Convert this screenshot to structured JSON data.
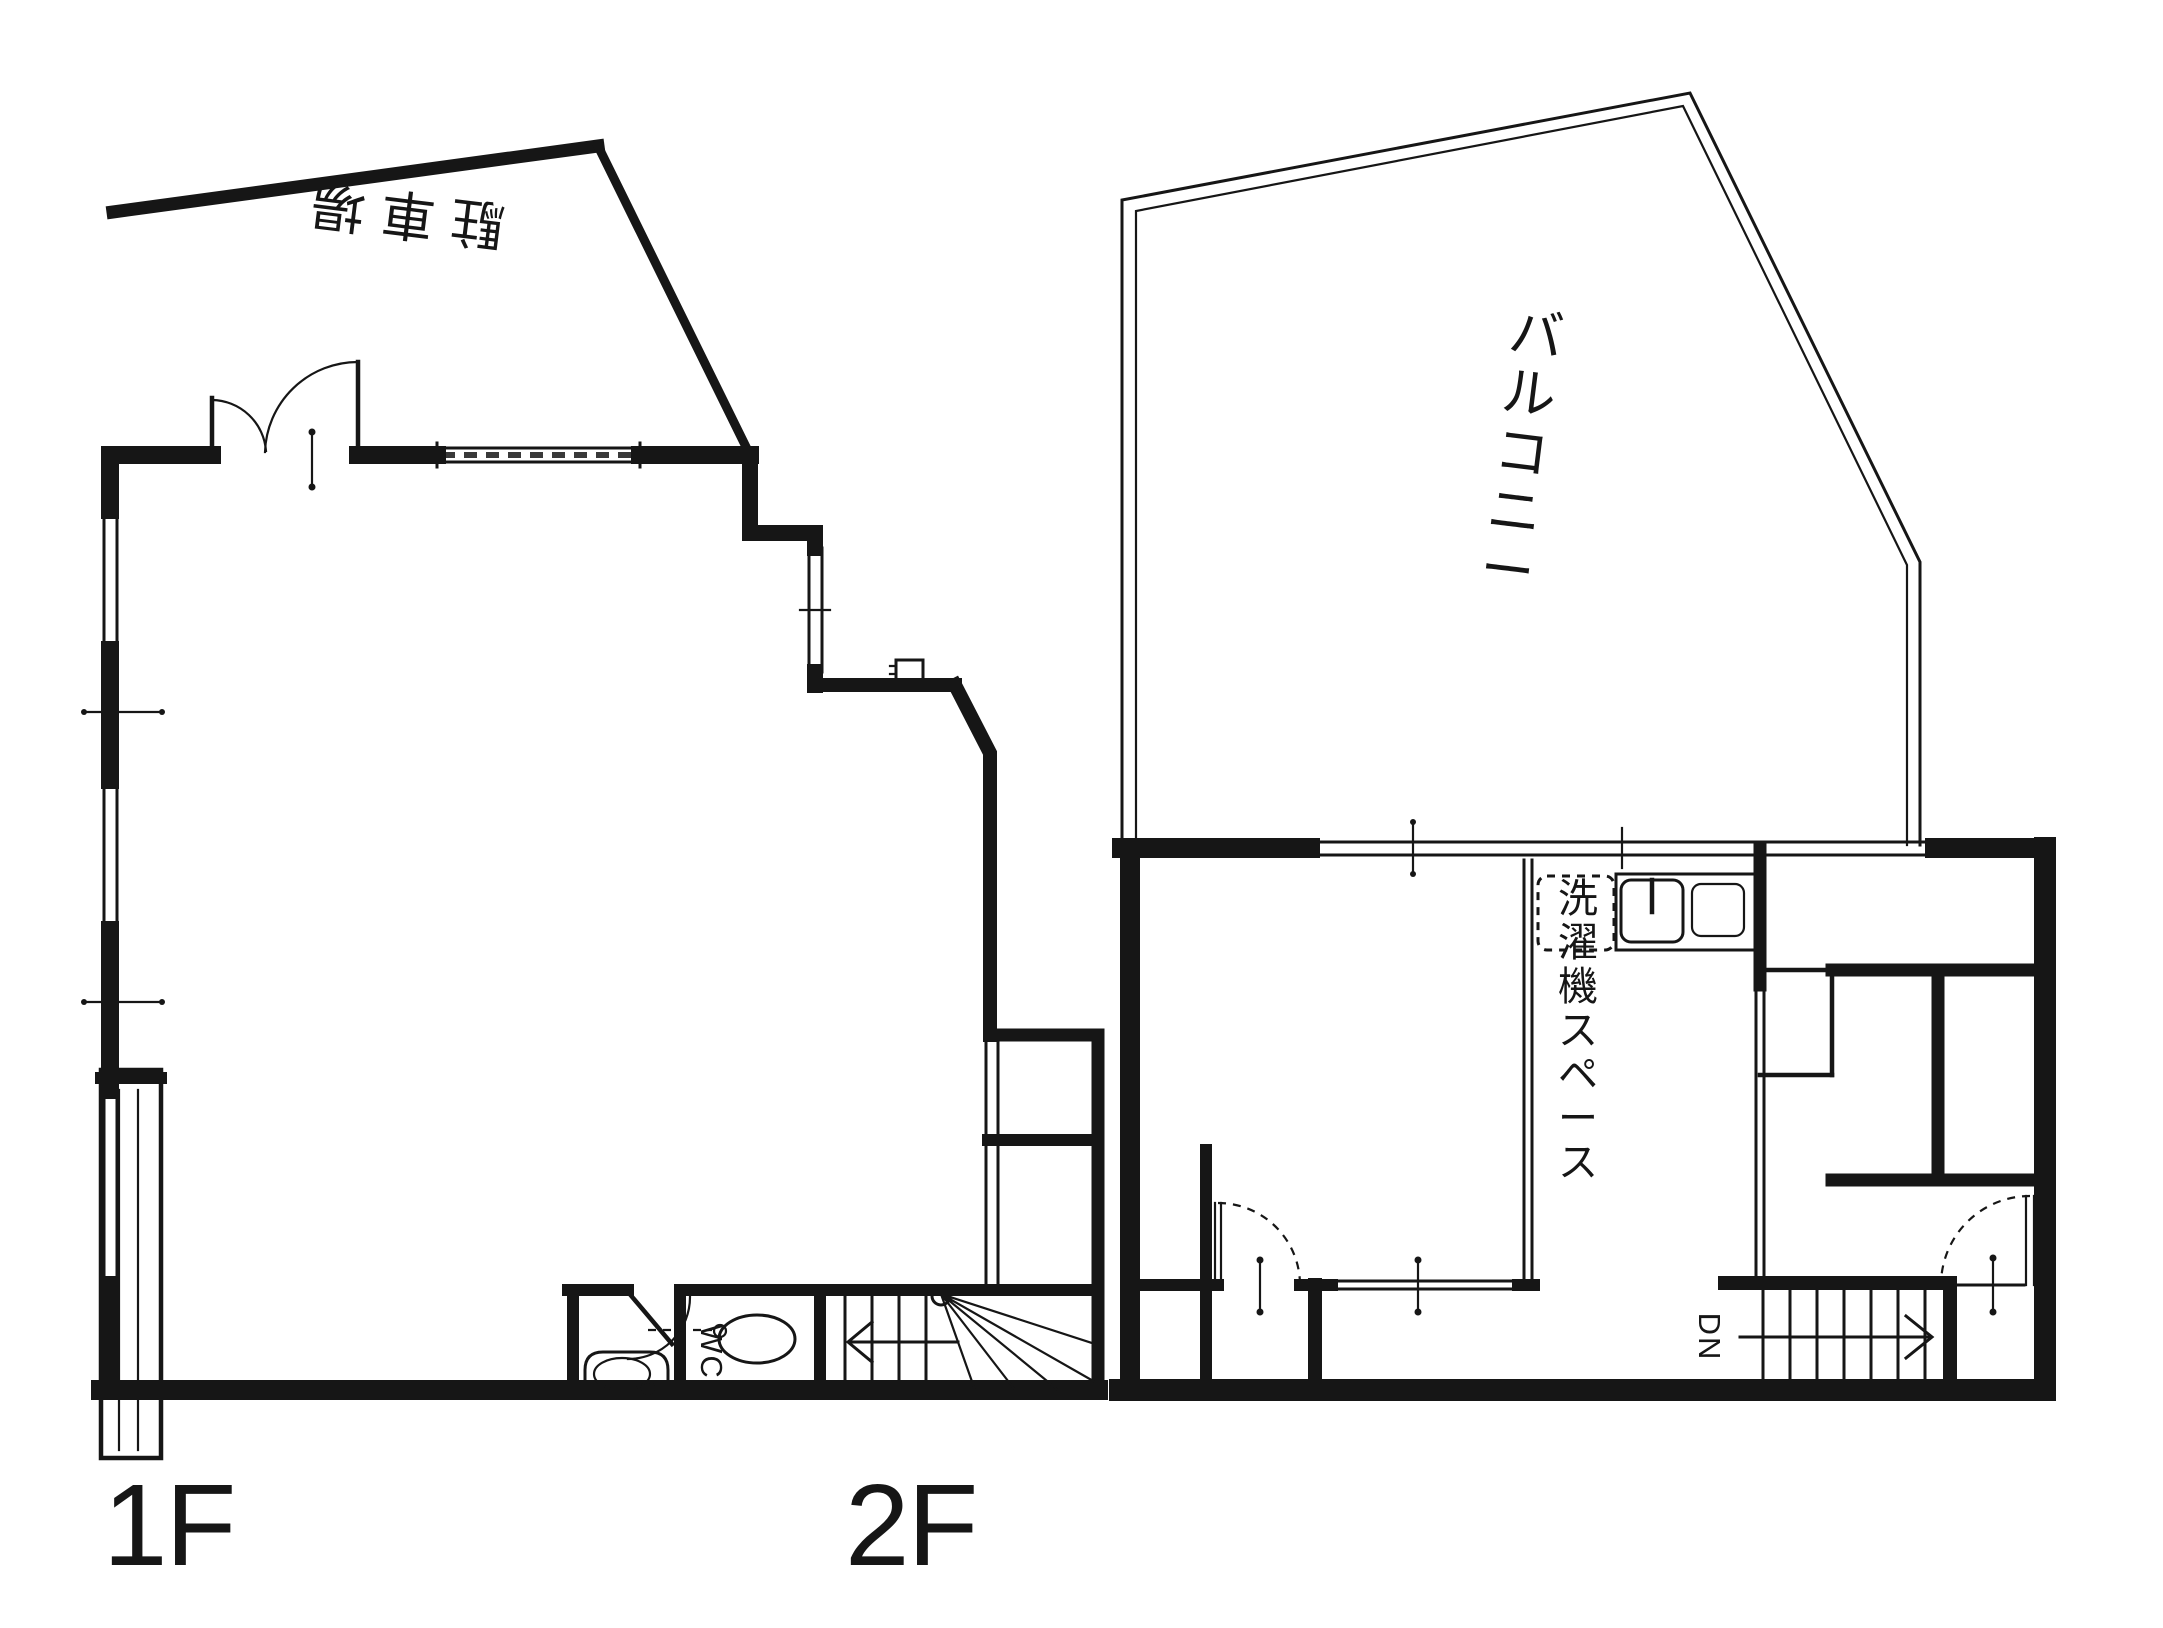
{
  "colors": {
    "line": "#161616",
    "background": "#ffffff"
  },
  "floors": [
    {
      "label": "1F",
      "parking_label": "駐車場",
      "wc_label": "WC"
    },
    {
      "label": "2F",
      "balcony_label": "バルコニー",
      "laundry_label": "洗濯機スペース",
      "stairs_down_label": "DN"
    }
  ]
}
